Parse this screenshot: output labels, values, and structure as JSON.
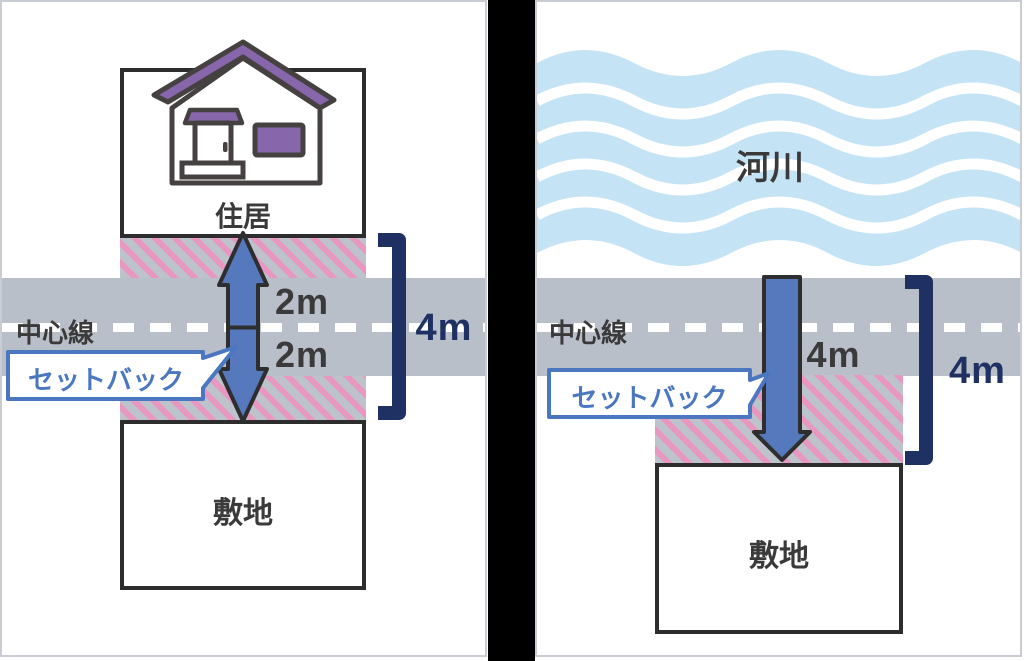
{
  "colors": {
    "road_gray": "#B9BFC8",
    "hatch_pink": "#E897C1",
    "hatch_gray": "#BDC3CB",
    "arrow_blue": "#5679BE",
    "bracket_navy": "#1E3162",
    "bubble_blue": "#4B77C0",
    "water_blue": "#C4E3F5",
    "roof_purple": "#8866AC",
    "outline_dark": "#2D2D2D",
    "text_dark": "#3A3A3A"
  },
  "left_panel": {
    "building_label": "住居",
    "site_label": "敷地",
    "centerline_label": "中心線",
    "setback_label": "セットバック",
    "upper_setback": "2m",
    "lower_setback": "2m",
    "total_width": "4m"
  },
  "right_panel": {
    "river_label": "河川",
    "site_label": "敷地",
    "centerline_label": "中心線",
    "setback_label": "セットバック",
    "setback_distance": "4m",
    "total_width": "4m"
  }
}
